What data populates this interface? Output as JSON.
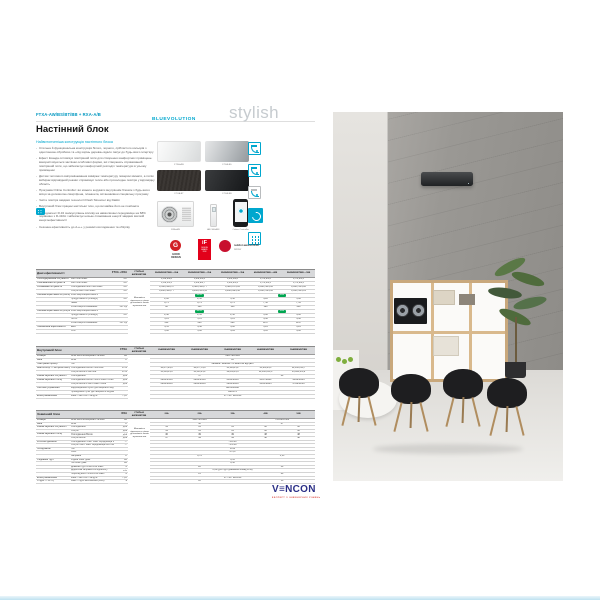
{
  "header": {
    "model_code": "FTXA-AW/BS/BT/BB + RXA-A/B",
    "title": "Настінний блок",
    "subtitle": "Найвитонченіша конструкція настінного блока"
  },
  "branding": {
    "bluevolution": "BLUEVOLUTION",
    "stylish": "stylish"
  },
  "intro": {
    "bullets": [
      "Стильна й функціональна конструкція білого, чорного, сріблястого кольорів з однотонною обробкою та «під корінь дерева» вдало пасує до будь-якого інтер'єру",
      "Ефект Коанда оптимізує повітряний потік для створення комфортних приміщень: використовуються заслінки особливої форми, які створюють спрямований повітряний потік, що забезпечує комфортний розподіл температури в усьому приміщенні",
      "Датчик теплового випромінювання вимірює температуру поверхні кімнати, а потім вибирає відповідний режим: спрямовує тепле або прохолодне повітря у відповідну область",
      "Програма Online Controller: ви можете керувати внутрішнім блоком з будь-якого місця за допомогою смартфона, планшета, встановивши спеціальну програму",
      "Чисте повітря завдяки технології Flash Streamer від Daikin",
      "Внутрішній блок працює настільки тихо, що ви майже його не помічаєте",
      "Холодоагент R-32 знижує рівень впливу на навколишнє середовище на 68% порівняно з R-410A і забезпечує низьке споживання енергії завдяки високій енергоефективності",
      "Сезонна ефективність до А+++ у режимі охолодження та обігріву"
    ]
  },
  "products": [
    {
      "caption": "FTXA-AW",
      "style": "white"
    },
    {
      "caption": "FTXA-BS",
      "style": "silver"
    },
    {
      "caption": "FTXA-BT",
      "style": "blackwood"
    },
    {
      "caption": "FTXA-BB",
      "style": "black"
    },
    {
      "caption": "RXA-A/B",
      "style": "outdoor"
    },
    {
      "caption": "ARC466A58",
      "style": "remote"
    },
    {
      "caption": "Online Controller",
      "style": "phone"
    }
  ],
  "feature_icons": [
    {
      "name": "room-airflow-icon",
      "style": "room"
    },
    {
      "name": "room-sensor-icon",
      "style": "room"
    },
    {
      "name": "unit-dimensions-icon",
      "style": "room gray"
    },
    {
      "name": "coanda-swirl-icon",
      "style": "filled"
    },
    {
      "name": "remote-grid-icon",
      "style": "grid"
    }
  ],
  "awards": {
    "good_design": {
      "icon": "G",
      "text": "GOOD\nDESIGN"
    },
    "if_design": {
      "top": "iF",
      "sub": "DESIGN\nAWARD\n2018"
    },
    "reddot": {
      "line1": "reddot award 2018",
      "line2": "winner"
    }
  },
  "colors": {
    "accent": "#00a7ce",
    "green_badge": "#00a651",
    "award_red": "#c8102e",
    "vencon_blue": "#2b2f86",
    "vencon_red": "#d93a30"
  },
  "spec": {
    "sections": [
      {
        "title": "Дані ефективності",
        "series": "FTXA + RXA",
        "mid_header": "СТИЛЬНІ AW/BS/BT/BB",
        "models": [
          "20AW/BS/BT/BB + 20A",
          "25AW/BS/BT/BB + 25A",
          "35AW/BS/BT/BB + 35A",
          "42AW/BS/BT/BB + 42B",
          "50AW/BS/BT/BB + 50B"
        ],
        "midnote": "Можливість підключення тільки до зовнішніх блоків мультисистем",
        "rows": [
          {
            "l": "Охолоджувальна потужність",
            "s": "Мін./Ном./Макс.",
            "u": "кВт",
            "v": [
              [
                "1,3/2,0/2,6"
              ],
              [
                "1,4/2,5/3,2"
              ],
              [
                "1,4/3,5/4,0"
              ],
              [
                "1,7/4,2/5,0"
              ],
              [
                "1,7/5,0/5,3"
              ]
            ]
          },
          {
            "l": "Опалювальна потужність",
            "s": "Мін./Ном./Макс.",
            "u": "кВт",
            "v": [
              [
                "1,3/2,5/3,5"
              ],
              [
                "1,4/2,8/4,7"
              ],
              [
                "1,4/4,0/5,2"
              ],
              [
                "1,7/5,4/6,5"
              ],
              [
                "1,7/5,8/6,5"
              ]
            ]
          },
          {
            "l": "Споживана потужність",
            "s": "Охолодження Мін./Ном./Макс.",
            "u": "кВт",
            "v": [
              [
                "0,31/0,43/0,57"
              ],
              [
                "0,32/0,56/0,77"
              ],
              [
                "0,32/0,87/1,06"
              ],
              [
                "0,43/1,30/1,60"
              ],
              [
                "0,43/1,55/1,80"
              ]
            ]
          },
          {
            "l": "",
            "s": "Обігрів Мін./Ном./Макс.",
            "u": "кВт",
            "v": [
              [
                "0,26/0,50/0,77"
              ],
              [
                "0,26/0,56/1,11"
              ],
              [
                "0,26/0,99/1,38"
              ],
              [
                "0,41/1,31/1,60"
              ],
              [
                "0,41/1,45/1,81"
              ]
            ]
          },
          {
            "l": "Сезонна ефективність (охолодження)",
            "s": "Клас енергоефективності",
            "u": "",
            "v": [
              [
                "А+++",
                3,
                "g"
              ],
              [
                "А++",
                2,
                "g"
              ]
            ]
          },
          {
            "l": "",
            "s": "Продуктивність (Pdesign)",
            "u": "кВт",
            "v": [
              [
                "2,00"
              ],
              [
                "2,50"
              ],
              [
                "3,50"
              ],
              [
                "4,20"
              ],
              [
                "5,00"
              ]
            ]
          },
          {
            "l": "",
            "s": "SEER",
            "u": "",
            "v": [
              [
                "8,75"
              ],
              [
                "8,74"
              ],
              [
                "8,73"
              ],
              [
                "7,50"
              ],
              [
                "7,33"
              ]
            ]
          },
          {
            "l": "",
            "s": "Річне енергоспоживання",
            "u": "кВт·год",
            "v": [
              [
                "80"
              ],
              [
                "100"
              ],
              [
                "140"
              ],
              [
                "196"
              ],
              [
                "239"
              ]
            ]
          },
          {
            "l": "Сезонна ефективність (обігрів)",
            "s": "Клас енергоефективності",
            "u": "",
            "v": [
              [
                "А+++",
                3,
                "g"
              ],
              [
                "А++",
                2,
                "g"
              ]
            ]
          },
          {
            "l": "",
            "s": "Продуктивність (Pdesign)",
            "u": "кВт",
            "v": [
              [
                "2,40"
              ],
              [
                "2,45"
              ],
              [
                "2,50"
              ],
              [
                "3,80"
              ],
              [
                "4,00"
              ]
            ]
          },
          {
            "l": "",
            "s": "SCOP",
            "u": "",
            "v": [
              [
                "5,15"
              ],
              [
                "5,15"
              ],
              [
                "5,15"
              ],
              [
                "4,60"
              ],
              [
                "4,60"
              ]
            ]
          },
          {
            "l": "",
            "s": "Річне енергоспоживання",
            "u": "кВт·год",
            "v": [
              [
                "652"
              ],
              [
                "666"
              ],
              [
                "680"
              ],
              [
                "1157"
              ],
              [
                "1217"
              ]
            ]
          },
          {
            "l": "Номінальна ефективність",
            "s": "EER",
            "u": "",
            "v": [
              [
                "4,55"
              ],
              [
                "4,46"
              ],
              [
                "4,02"
              ],
              [
                "3,23"
              ],
              [
                "3,23"
              ]
            ]
          },
          {
            "l": "",
            "s": "COP",
            "u": "",
            "v": [
              [
                "5,00"
              ],
              [
                "5,00"
              ],
              [
                "4,04"
              ],
              [
                "4,12"
              ],
              [
                "4,00"
              ]
            ]
          }
        ]
      },
      {
        "title": "Внутрішній блок",
        "series": "FTXA",
        "mid_header": "СТИЛЬНІ AW/BS/BT/BB",
        "models": [
          "20AW/BS/BT/BB",
          "25AW/BS/BT/BB",
          "35AW/BS/BT/BB",
          "42AW/BS/BT/BB",
          "50AW/BS/BT/BB"
        ],
        "midnote": "",
        "rows": [
          {
            "l": "Розміри",
            "s": "Блок Висота×Ширина×Глибина",
            "u": "мм",
            "v": [
              [
                "295×798×189",
                5
              ]
            ]
          },
          {
            "l": "Вага",
            "s": "Блок",
            "u": "кг",
            "v": [
              [
                "12",
                5
              ]
            ]
          },
          {
            "l": "Повітряний фільтр",
            "s": "Тип",
            "u": "",
            "v": [
              [
                "Знімний / миючий / із захистом від цвілі",
                5
              ]
            ]
          },
          {
            "l": "Вентилятор — Витрата повітря",
            "s": "Охолодження Висок./Ном./Мін.",
            "u": "м³/хв",
            "v": [
              [
                "10,6/7,4/4,6"
              ],
              [
                "10,6/7,7/4,8"
              ],
              [
                "11,1/8,2/5,2"
              ],
              [
                "11,9/9,3/6,1"
              ],
              [
                "12,6/10,3/6,7"
              ]
            ]
          },
          {
            "l": "",
            "s": "Обігрів Висок./Ном./Мін.",
            "u": "м³/хв",
            "v": [
              [
                "11,3/8,2/4,9"
              ],
              [
                "11,5/8,5/5,2"
              ],
              [
                "12,0/9,2/5,6"
              ],
              [
                "12,8/10,4/6,3"
              ],
              [
                "13,8/11,4/6,8"
              ]
            ]
          },
          {
            "l": "Рівень звукової потужності",
            "s": "Охолодження",
            "u": "дБА",
            "v": [
              [
                "57",
                3
              ],
              [
                "60",
                2
              ]
            ]
          },
          {
            "l": "Рівень звукового тиску",
            "s": "Охолодження Висок./Ном./Низьк./Тихий",
            "u": "дБА",
            "v": [
              [
                "39/33/25/19"
              ],
              [
                "39/33/25/19"
              ],
              [
                "41/34/26/19"
              ],
              [
                "45/37/29/21"
              ],
              [
                "46/38/30/24"
              ]
            ]
          },
          {
            "l": "",
            "s": "Обігрів Висок./Ном./Низьк./Тихий",
            "u": "дБА",
            "v": [
              [
                "39/34/28/19"
              ],
              [
                "39/34/28/19"
              ],
              [
                "39/34/28/19"
              ],
              [
                "41/35/29/25"
              ],
              [
                "47/39/31/26"
              ]
            ]
          },
          {
            "l": "Системи управління",
            "s": "Інфрачервоний пульт дистанційного керування",
            "u": "",
            "v": [
              [
                "ARC466A58",
                5
              ]
            ]
          },
          {
            "l": "",
            "s": "Проводовий пульт дистанційного керування",
            "u": "",
            "v": [
              [
                "BRC073",
                5
              ]
            ]
          },
          {
            "l": "Електроживлення",
            "s": "Фаза / Частота / Напруга",
            "u": "Гц/В",
            "v": [
              [
                "1~ / 50 / 220-240",
                5
              ]
            ]
          }
        ]
      },
      {
        "title": "Зовнішній блок",
        "series": "RXA",
        "mid_header": "СТИЛЬНІ AW/BS/BT/BB",
        "models": [
          "20A",
          "25A",
          "35A",
          "42B",
          "50B"
        ],
        "midnote": "Можливість підключення тільки до зовнішніх блоків мультисистем",
        "rows": [
          {
            "l": "Розміри",
            "s": "Блок Висота×Ширина×Глибина",
            "u": "мм",
            "v": [
              [
                "550×765×285",
                3
              ],
              [
                "735×825×300",
                2
              ]
            ]
          },
          {
            "l": "Вага",
            "s": "Блок",
            "u": "кг",
            "v": [
              [
                "32",
                3
              ],
              [
                "47",
                2
              ]
            ]
          },
          {
            "l": "Рівень звукової потужності",
            "s": "Охолодження",
            "u": "дБА",
            "v": [
              [
                "59"
              ],
              [
                "61"
              ],
              [
                "61"
              ],
              [
                "62"
              ],
              [
                "62"
              ]
            ]
          },
          {
            "l": "",
            "s": "Обігрів",
            "u": "дБА",
            "v": [
              [
                "59"
              ],
              [
                "61"
              ],
              [
                "61"
              ],
              [
                "62"
              ],
              [
                "62"
              ]
            ]
          },
          {
            "l": "Рівень звукового тиску",
            "s": "Охолодження Висок.",
            "u": "дБА",
            "v": [
              [
                "46"
              ],
              [
                "49"
              ],
              [
                "49"
              ],
              [
                "48"
              ],
              [
                "48"
              ]
            ]
          },
          {
            "l": "",
            "s": "Обігрів Висок.",
            "u": "дБА",
            "v": [
              [
                "47"
              ],
              [
                "49"
              ],
              [
                "49"
              ],
              [
                "48"
              ],
              [
                "48"
              ]
            ]
          },
          {
            "l": "Робочий діапазон",
            "s": "Охолодження Темп. зовн. середовища Мін.~Макс.",
            "u": "°C",
            "v": [
              [
                "−10~46",
                5
              ]
            ]
          },
          {
            "l": "",
            "s": "Обігрів Темп. зовн. середовища Мін.~Макс.",
            "u": "°C",
            "v": [
              [
                "−15~18",
                5
              ]
            ]
          },
          {
            "l": "Холодоагент",
            "s": "Тип",
            "u": "",
            "v": [
              [
                "R-32",
                5
              ]
            ]
          },
          {
            "l": "",
            "s": "GWP",
            "u": "",
            "v": [
              [
                "675,0",
                5
              ]
            ]
          },
          {
            "l": "",
            "s": "Заправка",
            "u": "кг",
            "v": [
              [
                "0,76",
                3
              ],
              [
                "1,15",
                2
              ]
            ]
          },
          {
            "l": "З'єднання труб",
            "s": "Рідина Зовн. діам.",
            "u": "мм",
            "v": [
              [
                "6,35",
                5
              ]
            ]
          },
          {
            "l": "",
            "s": "Газ Зовн. діам.",
            "u": "мм",
            "v": [
              [
                "9,50",
                5
              ]
            ]
          },
          {
            "l": "",
            "s": "Довжина труб Блок-блок Макс.",
            "u": "м",
            "v": [
              [
                "20",
                3
              ],
              [
                "30",
                2
              ]
            ]
          },
          {
            "l": "",
            "s": "Додаткова заправка холодоагенту",
            "u": "кг/м",
            "v": [
              [
                "0,02 (для труб довжиною понад 10 м)",
                5
              ]
            ]
          },
          {
            "l": "",
            "s": "Перепад висот Блок-блок Макс.",
            "u": "м",
            "v": [
              [
                "15",
                3
              ],
              [
                "20",
                2
              ]
            ]
          },
          {
            "l": "Електроживлення",
            "s": "Фаза / Частота / Напруга",
            "u": "Гц/В",
            "v": [
              [
                "1~ / 50 / 220-240",
                5
              ]
            ]
          },
          {
            "l": "Струм — 50 Гц",
            "s": "Макс. струм запобіжника (MFA)",
            "u": "А",
            "v": [
              [
                "10",
                3
              ],
              [
                "16",
                2
              ]
            ]
          }
        ]
      }
    ]
  },
  "footer": {
    "logo_v": "V",
    "logo_e": "≡",
    "logo_rest": "NCON",
    "tagline": "ЕКСПЕРТ З ІНЖЕНЕРНИХ РІШЕНЬ"
  }
}
